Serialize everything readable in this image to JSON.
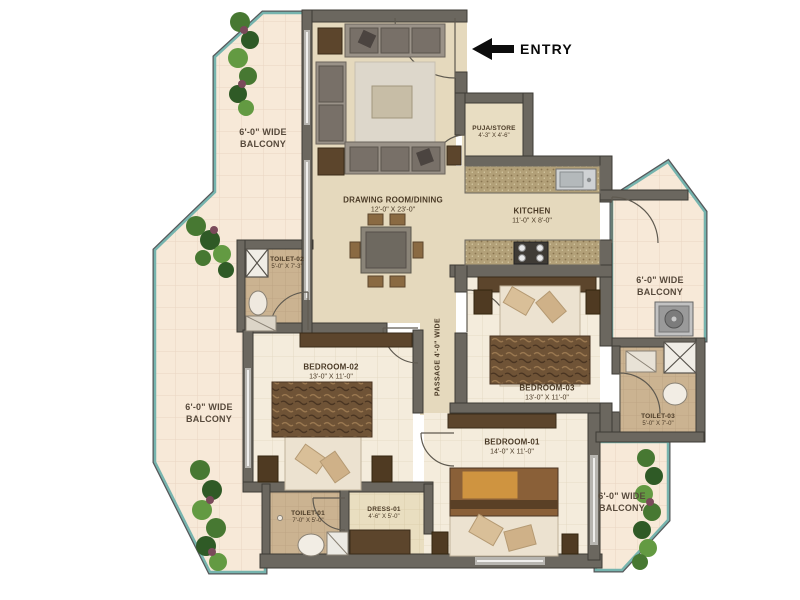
{
  "entry": {
    "label": "ENTRY"
  },
  "rooms": {
    "drawing": {
      "name": "DRAWING ROOM/DINING",
      "dims": "12'-0\" X 23'-0\""
    },
    "puja": {
      "name": "PUJA/STORE",
      "dims": "4'-3\" X 4'-6\""
    },
    "kitchen": {
      "name": "KITCHEN",
      "dims": "11'-0\" X 8'-0\""
    },
    "toilet2": {
      "name": "TOILET-02",
      "dims": "5'-0\" X 7'-3\""
    },
    "bedroom2": {
      "name": "BEDROOM-02",
      "dims": "13'-0\" X 11'-0\""
    },
    "bedroom3": {
      "name": "BEDROOM-03",
      "dims": "13'-0\" X 11'-0\""
    },
    "bedroom1": {
      "name": "BEDROOM-01",
      "dims": "14'-0\" X 11'-0\""
    },
    "toilet3": {
      "name": "TOILET-03",
      "dims": "5'-0\" X 7'-0\""
    },
    "toilet1": {
      "name": "TOILET-01",
      "dims": "7'-0\" X 5'-0\""
    },
    "dress": {
      "name": "DRESS-01",
      "dims": "4'-6\" X 5'-0\""
    },
    "passage": {
      "name": "PASSAGE 4'-0\" WIDE"
    }
  },
  "balconies": {
    "top_left": "6'-0\" WIDE BALCONY",
    "left": "6'-0\" WIDE BALCONY",
    "right": "6'-0\" WIDE BALCONY",
    "bottom_right": "6'-0\" WIDE BALCONY"
  },
  "colors": {
    "balcony_edge": "#76b4ae",
    "wall": "#6b675f",
    "floor_main": "#e5d9bd",
    "floor_bedroom": "#f4ecdc",
    "floor_toilet": "#cbb391",
    "floor_balcony": "#f7e9d8",
    "furniture_dark": "#5c452c",
    "plant_green": "#477832",
    "label_text": "#4a3a26"
  }
}
